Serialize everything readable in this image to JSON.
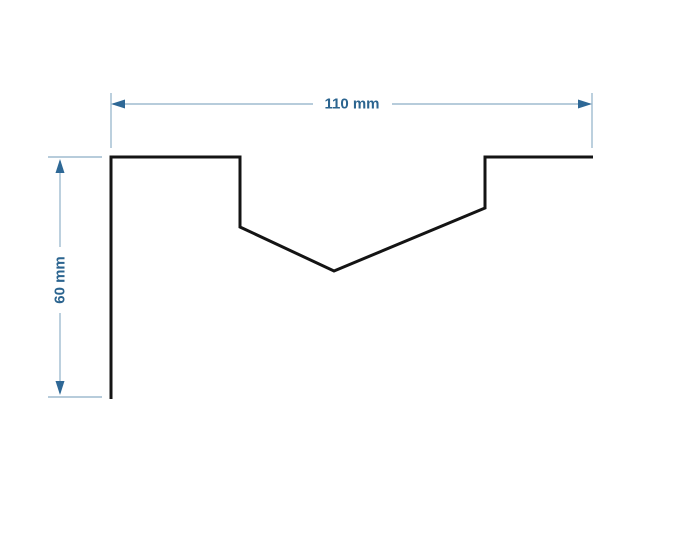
{
  "diagram": {
    "type": "technical-drawing",
    "description": "Profile cross-section with V-notch, dimensioned",
    "canvas": {
      "width": 675,
      "height": 540,
      "background": "#ffffff"
    },
    "profile": {
      "stroke": "#141414",
      "stroke_width": 3,
      "points": [
        [
          111,
          399
        ],
        [
          111,
          157
        ],
        [
          240,
          157
        ],
        [
          240,
          227
        ],
        [
          334,
          271
        ],
        [
          485,
          208
        ],
        [
          485,
          157
        ],
        [
          593,
          157
        ]
      ]
    },
    "dimension_style": {
      "line_color": "#9fbccf",
      "arrow_color": "#2e6896",
      "text_color": "#2b648f",
      "line_width": 1.4,
      "arrow_length": 14,
      "arrow_half_width": 4.5,
      "font_size": 15
    },
    "width_dimension": {
      "label": "110 mm",
      "value_mm": 110,
      "orientation": "horizontal",
      "line_y": 104,
      "start_x": 111,
      "end_x": 592,
      "label_center_x": 352,
      "label_gap": [
        313,
        392
      ],
      "extension_lines": {
        "x_left": 111,
        "x_right": 592,
        "y_top": 93,
        "y_bottom": 148
      }
    },
    "height_dimension": {
      "label": "60 mm",
      "value_mm": 60,
      "orientation": "vertical",
      "line_x": 60,
      "start_y": 159,
      "end_y": 395,
      "label_center_y": 280,
      "label_gap": [
        247,
        313
      ],
      "extension_lines": {
        "y_top": 157,
        "y_bottom": 397,
        "x_left": 48,
        "x_right": 102
      }
    }
  }
}
